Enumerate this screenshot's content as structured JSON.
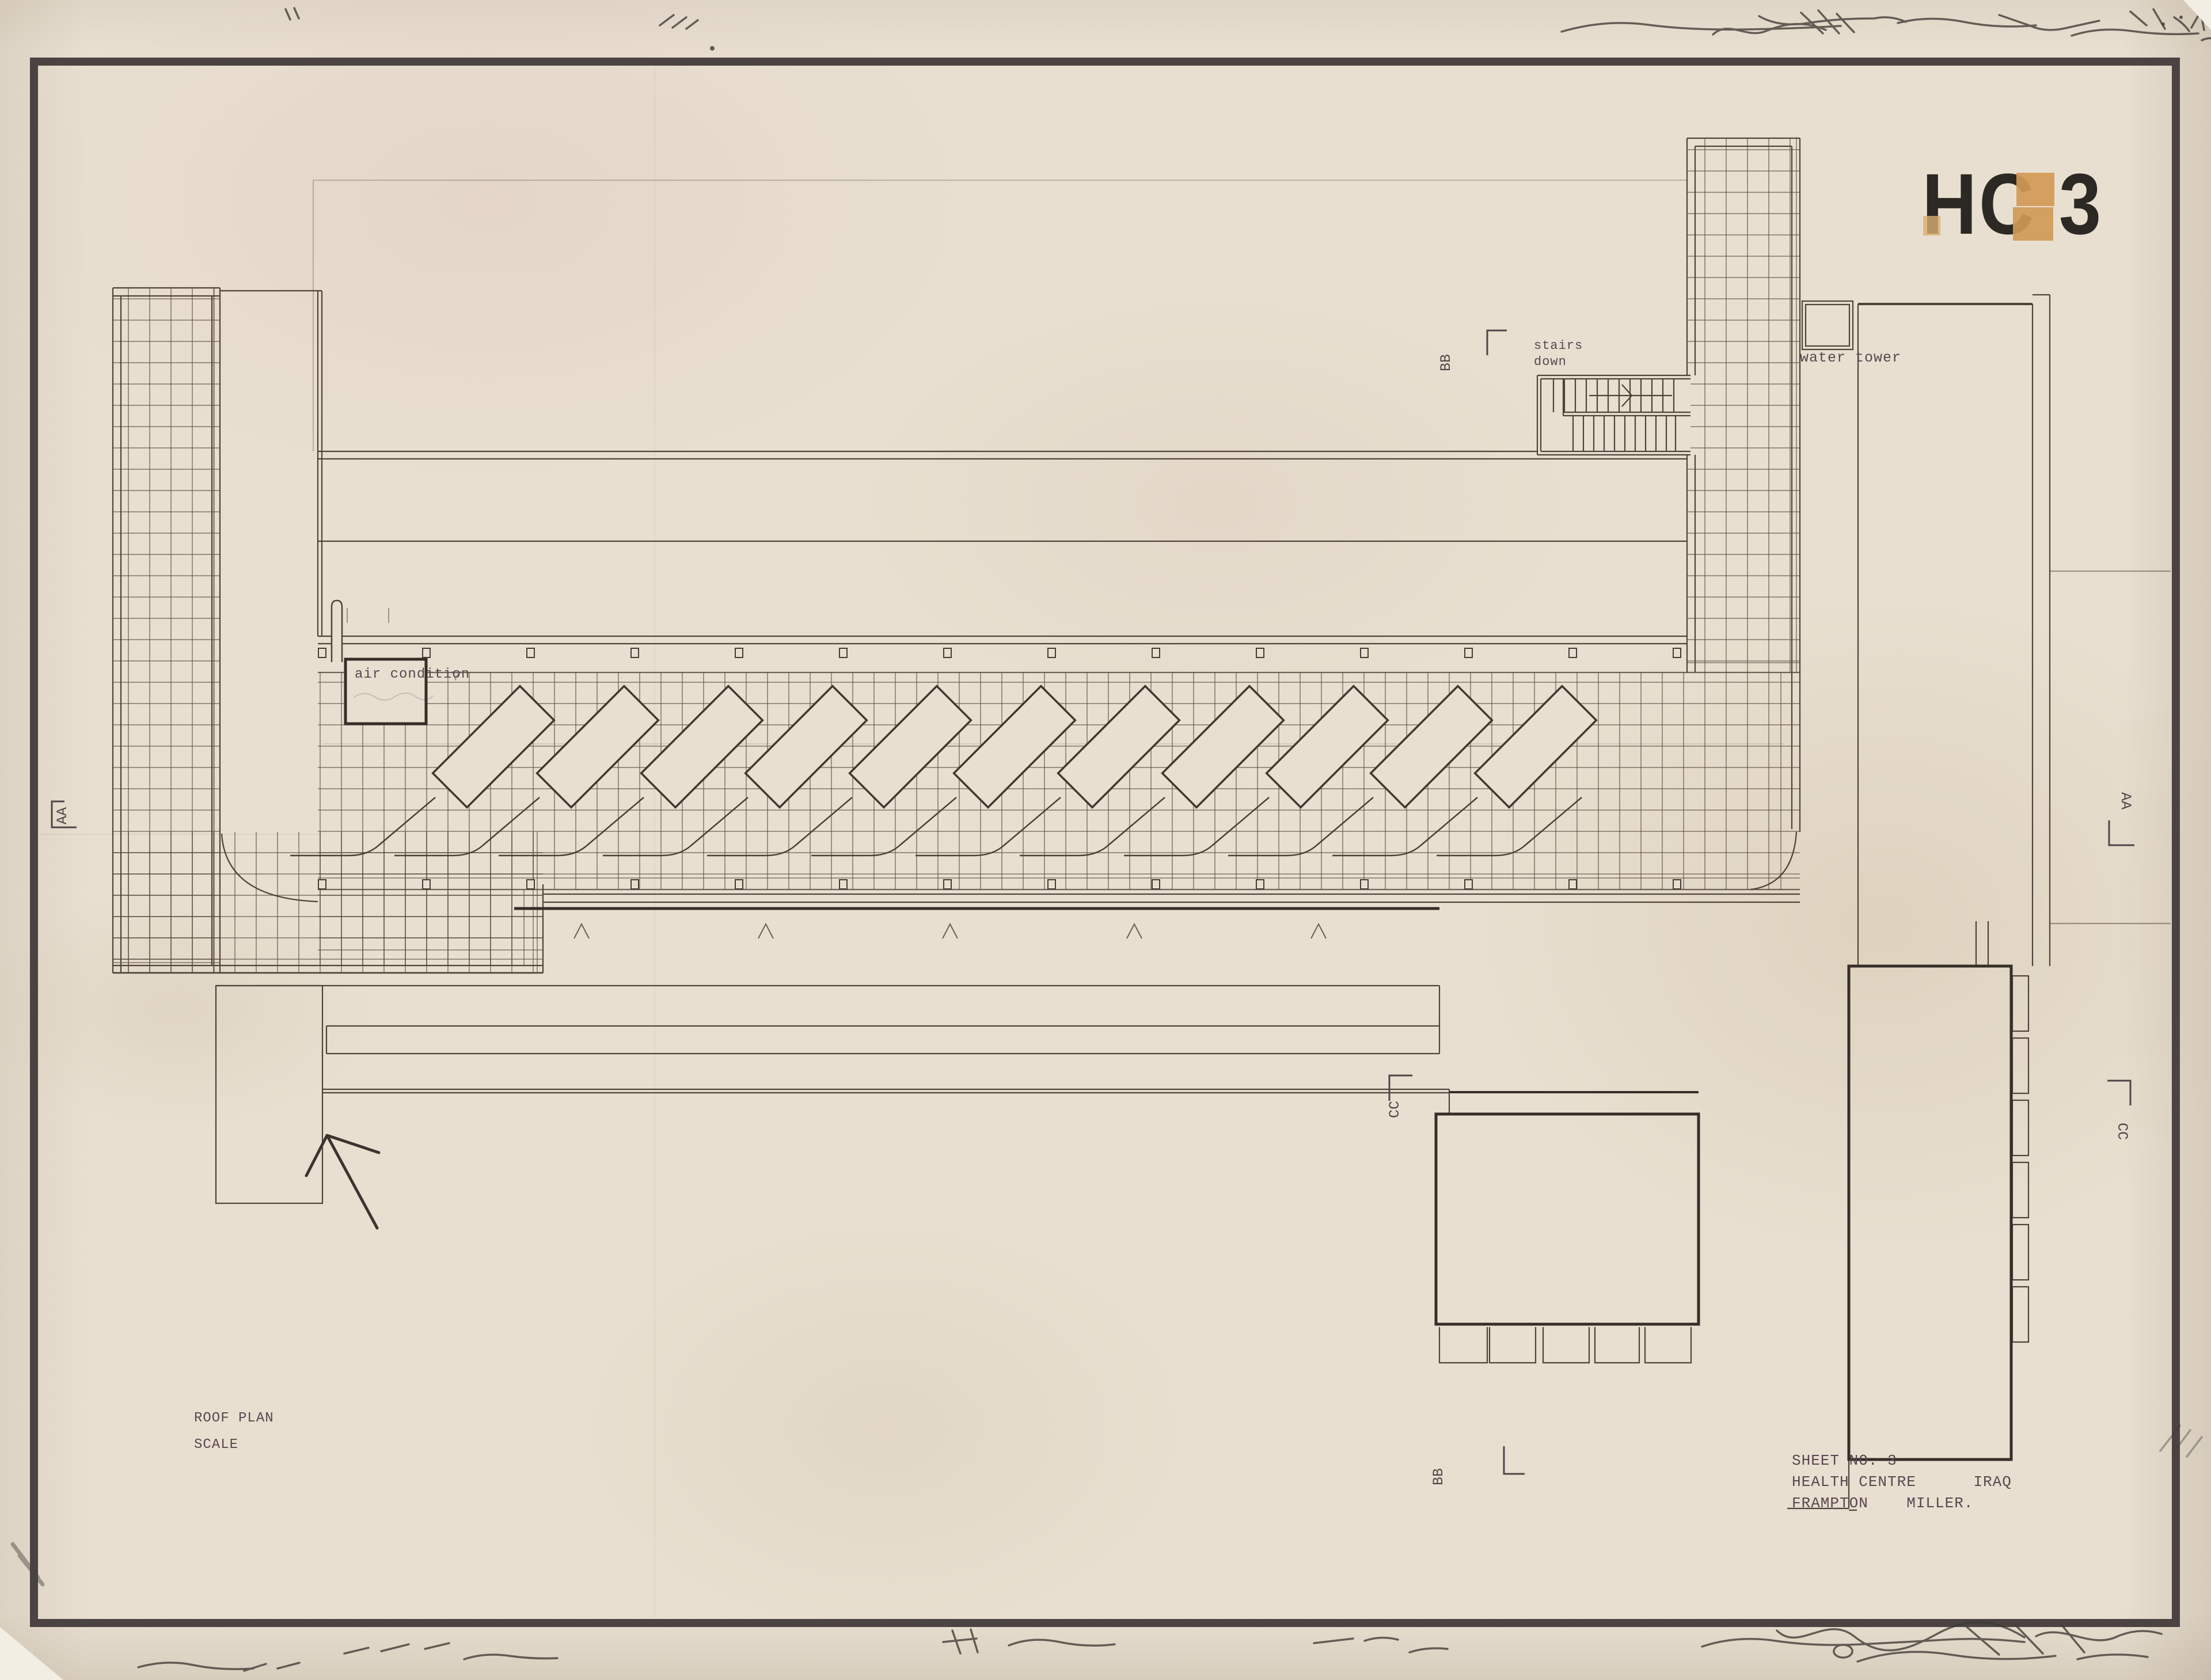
{
  "sheet": {
    "stamp_code": "HC 3",
    "plan_title": "ROOF PLAN",
    "scale_label": "SCALE",
    "title_block": {
      "sheet_no": "SHEET NO. 3",
      "project": "HEALTH CENTRE      IRAQ",
      "architects": "FRAMPTON    MILLER."
    }
  },
  "labels": {
    "stairs_line1": "stairs",
    "stairs_line2": "down",
    "water_tower": "water tower",
    "air_condition": "air condition"
  },
  "section_markers": {
    "aa_left": "AA",
    "aa_right": "AA",
    "bb_top": "BB",
    "bb_bottom": "BB",
    "cc_middle": "CC",
    "cc_right": "CC"
  },
  "colors": {
    "paper": "#e8dfd0",
    "ink_thin": "#4f4339",
    "ink_bold": "#362e28",
    "frame": "#4b4342",
    "stamp_ink": "#2c2824",
    "typewriter_ink": "#5a474f",
    "tape_orange": "#d39a55"
  }
}
